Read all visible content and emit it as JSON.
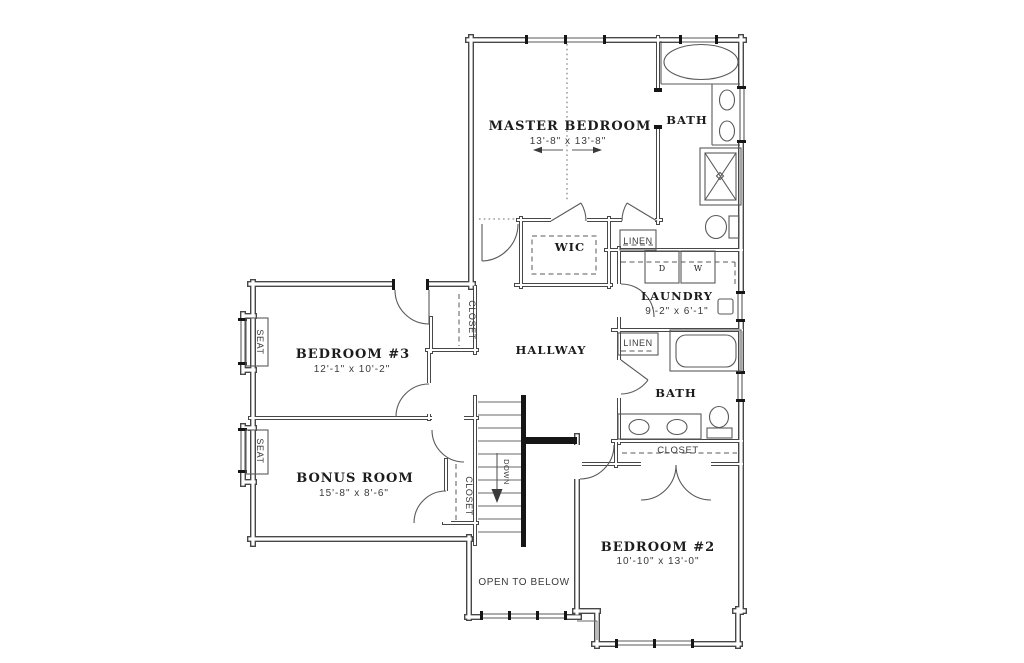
{
  "plan": {
    "title_hint": "second-floor residential plan",
    "rooms": {
      "master_bedroom": {
        "name": "MASTER BEDROOM",
        "dims": "13'-8\" x 13'-8\""
      },
      "master_bath": {
        "name": "BATH"
      },
      "wic": {
        "name": "WIC"
      },
      "laundry": {
        "name": "LAUNDRY",
        "dims": "9'-2\" x 6'-1\""
      },
      "hallway": {
        "name": "HALLWAY"
      },
      "bath2": {
        "name": "BATH"
      },
      "bedroom3": {
        "name": "BEDROOM #3",
        "dims": "12'-1\" x 10'-2\""
      },
      "bonus_room": {
        "name": "BONUS ROOM",
        "dims": "15'-8\" x 8'-6\""
      },
      "bedroom2": {
        "name": "BEDROOM #2",
        "dims": "10'-10\" x 13'-0\""
      }
    },
    "labels": {
      "linen_master": "LINEN",
      "linen_hall": "LINEN",
      "closet_bedroom3": "CLOSET",
      "closet_bonus": "CLOSET",
      "closet_bedroom2": "CLOSET",
      "seat_bedroom3": "SEAT",
      "seat_bonus": "SEAT",
      "open_to_below": "OPEN TO BELOW",
      "down": "DOWN",
      "dryer": "D",
      "washer": "W"
    },
    "colors": {
      "wall": "#474747",
      "fixture": "#5a5a5a",
      "room_text": "#1c1c1c",
      "dim_text": "#3a3a3a",
      "background": "#ffffff"
    }
  }
}
